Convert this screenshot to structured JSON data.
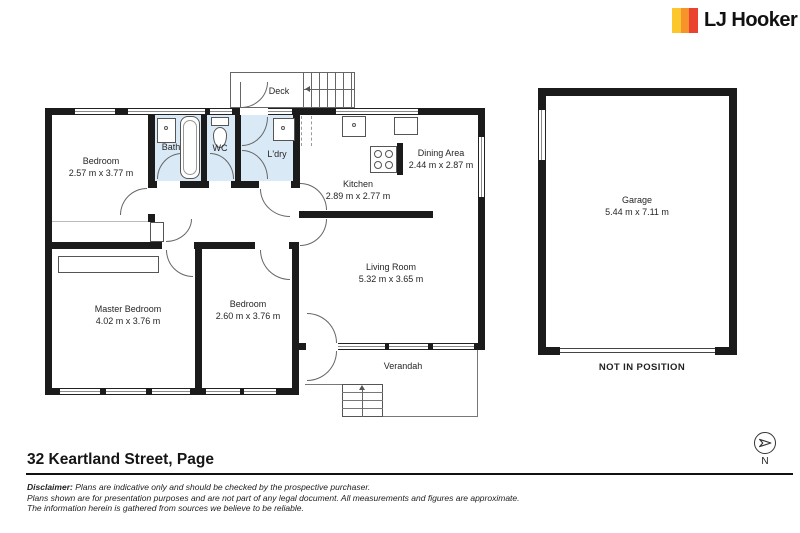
{
  "logo": {
    "text": "LJ Hooker",
    "stripe_colors": [
      "#FCC72D",
      "#F6932B",
      "#EB4130"
    ]
  },
  "floorplan": {
    "wall_color": "#1B1B1B",
    "wet_area_fill": "#D9E9F6",
    "rooms": {
      "bedroom1": {
        "name": "Bedroom",
        "dims": "2.57 m x 3.77 m"
      },
      "bath": {
        "name": "Bath"
      },
      "wc": {
        "name": "WC"
      },
      "ldry": {
        "name": "L'dry"
      },
      "deck": {
        "name": "Deck"
      },
      "kitchen": {
        "name": "Kitchen",
        "dims": "2.89 m x 2.77 m"
      },
      "dining": {
        "name": "Dining Area",
        "dims": "2.44 m x 2.87 m"
      },
      "living": {
        "name": "Living Room",
        "dims": "5.32 m x 3.65 m"
      },
      "master": {
        "name": "Master Bedroom",
        "dims": "4.02 m x 3.76 m"
      },
      "bedroom2": {
        "name": "Bedroom",
        "dims": "2.60 m x 3.76 m"
      },
      "verandah": {
        "name": "Verandah"
      },
      "garage": {
        "name": "Garage",
        "dims": "5.44 m x 7.11 m"
      }
    },
    "garage_note": "NOT IN POSITION"
  },
  "footer": {
    "address": "32 Keartland Street, Page",
    "disclaimer_label": "Disclaimer:",
    "disclaimer_line1": "Plans are indicative only and should be checked by the prospective purchaser.",
    "disclaimer_line2": "Plans shown are for presentation purposes and are not part of any legal document. All measurements and figures are approximate.",
    "disclaimer_line3": "The information herein is gathered from sources we believe to be reliable.",
    "compass_label": "N"
  }
}
